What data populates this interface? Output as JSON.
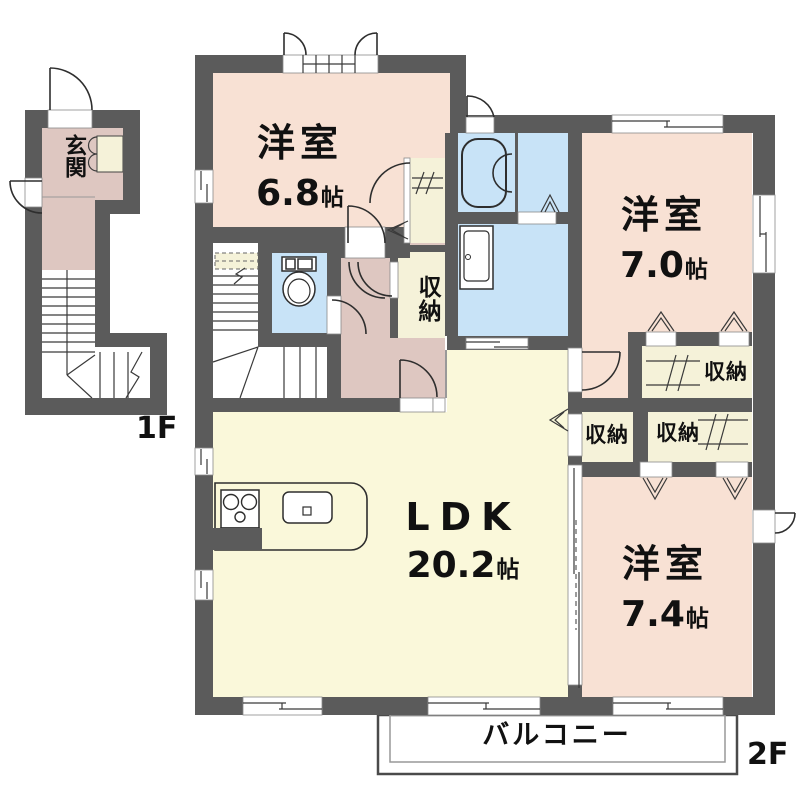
{
  "floor_plan": {
    "floor1_label": "1F",
    "floor2_label": "2F",
    "rooms": {
      "entrance": {
        "label": "玄関"
      },
      "western_68": {
        "label": "洋室",
        "size": "6.8",
        "unit": "帖"
      },
      "western_70": {
        "label": "洋室",
        "size": "7.0",
        "unit": "帖"
      },
      "western_74": {
        "label": "洋室",
        "size": "7.4",
        "unit": "帖"
      },
      "ldk": {
        "label": "LDK",
        "size": "20.2",
        "unit": "帖"
      },
      "balcony": {
        "label": "バルコニー"
      }
    },
    "storage_label": "収納",
    "colors": {
      "wall": "#5B5B5B",
      "room": "#F8E1D4",
      "hall": "#DEC7C1",
      "ldk": "#FAF8DA",
      "closet": "#F5F2D9",
      "wet": "#C8E3F7",
      "text": "#111111"
    }
  }
}
